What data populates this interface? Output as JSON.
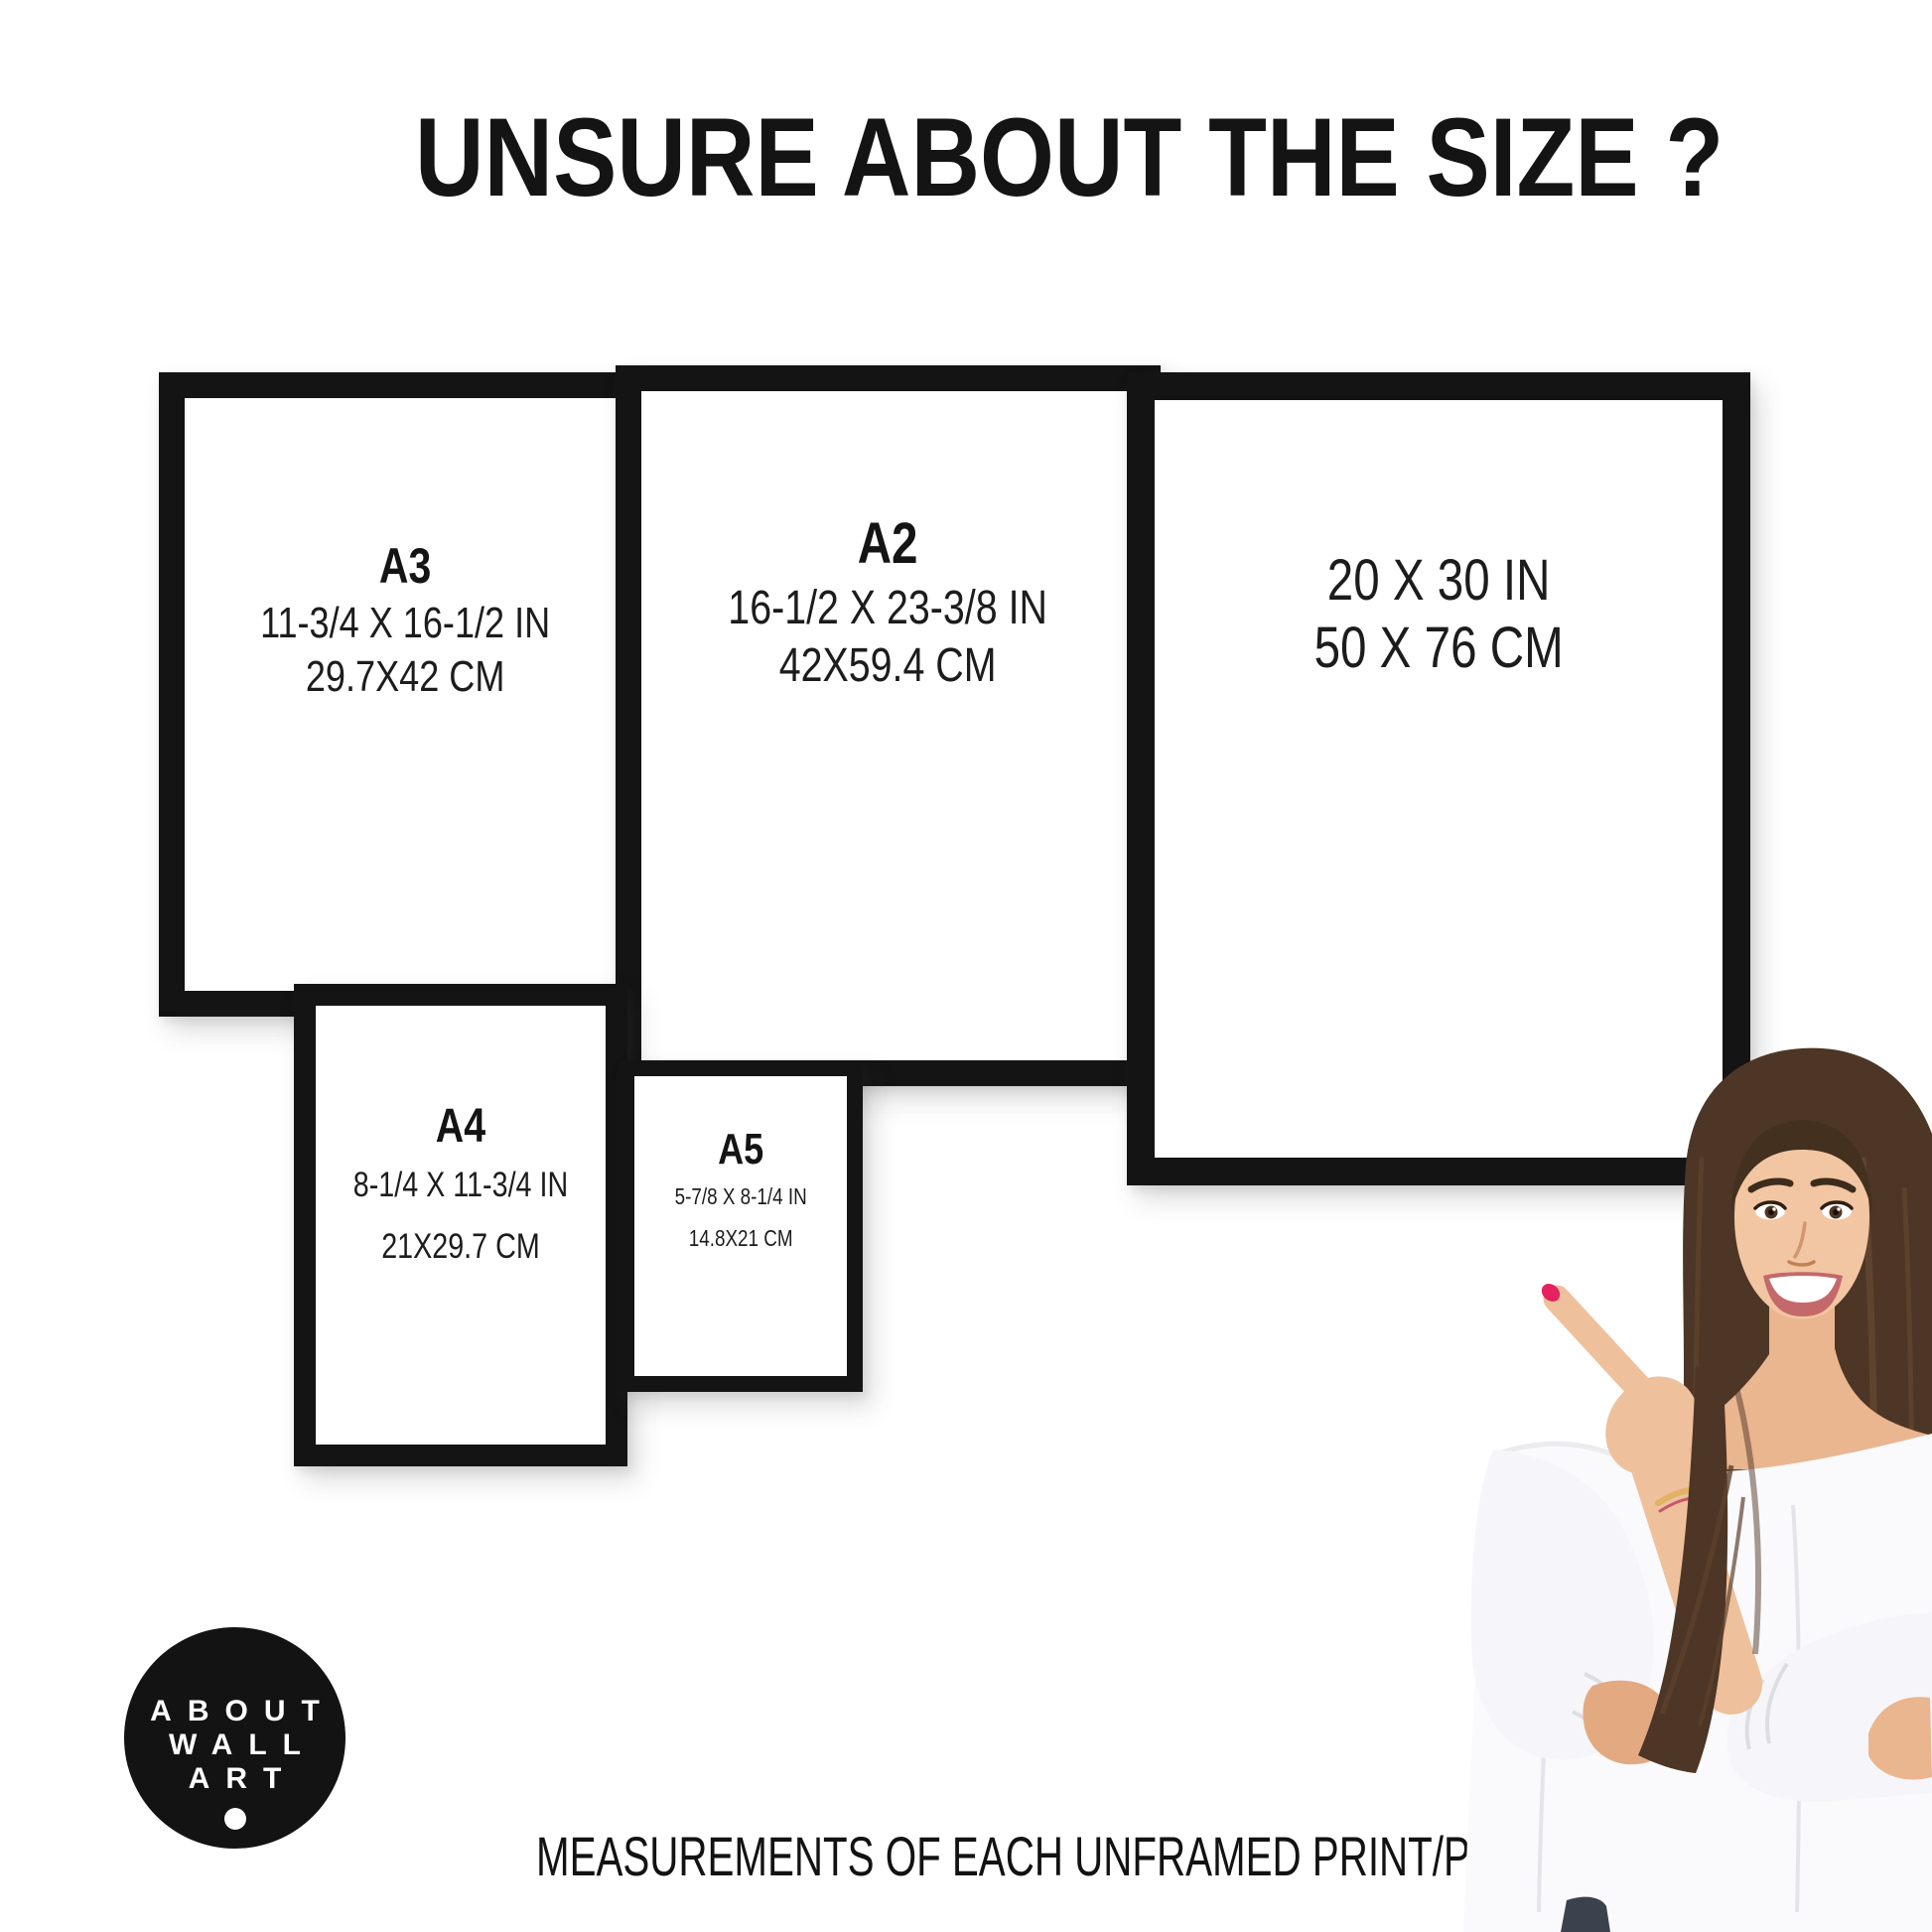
{
  "title": "UNSURE ABOUT THE SIZE ?",
  "frames": [
    {
      "name": "A3",
      "inches": "11-3/4 X 16-1/2 IN",
      "cm": "29.7X42 CM"
    },
    {
      "name": "A2",
      "inches": "16-1/2 X 23-3/8 IN",
      "cm": "42X59.4 CM"
    },
    {
      "name": "",
      "inches": "20 X 30 IN",
      "cm": "50 X 76 CM"
    },
    {
      "name": "A4",
      "inches": "8-1/4 X 11-3/4 IN",
      "cm": "21X29.7 CM"
    },
    {
      "name": "A5",
      "inches": "5-7/8 X 8-1/4 IN",
      "cm": "14.8X21 CM"
    }
  ],
  "logo": {
    "line1": "ABOUT",
    "line2": "WALL",
    "line3": "ART"
  },
  "footer_caption": "MEASUREMENTS OF EACH UNFRAMED PRINT/POSTER",
  "colors": {
    "background": "#ffffff",
    "frame": "#141414",
    "text": "#161616",
    "logo_background": "#131313",
    "logo_text": "#ffffff",
    "nail_polish": "#e5215f",
    "hair": "#4d3626",
    "blouse": "#fafafc"
  }
}
